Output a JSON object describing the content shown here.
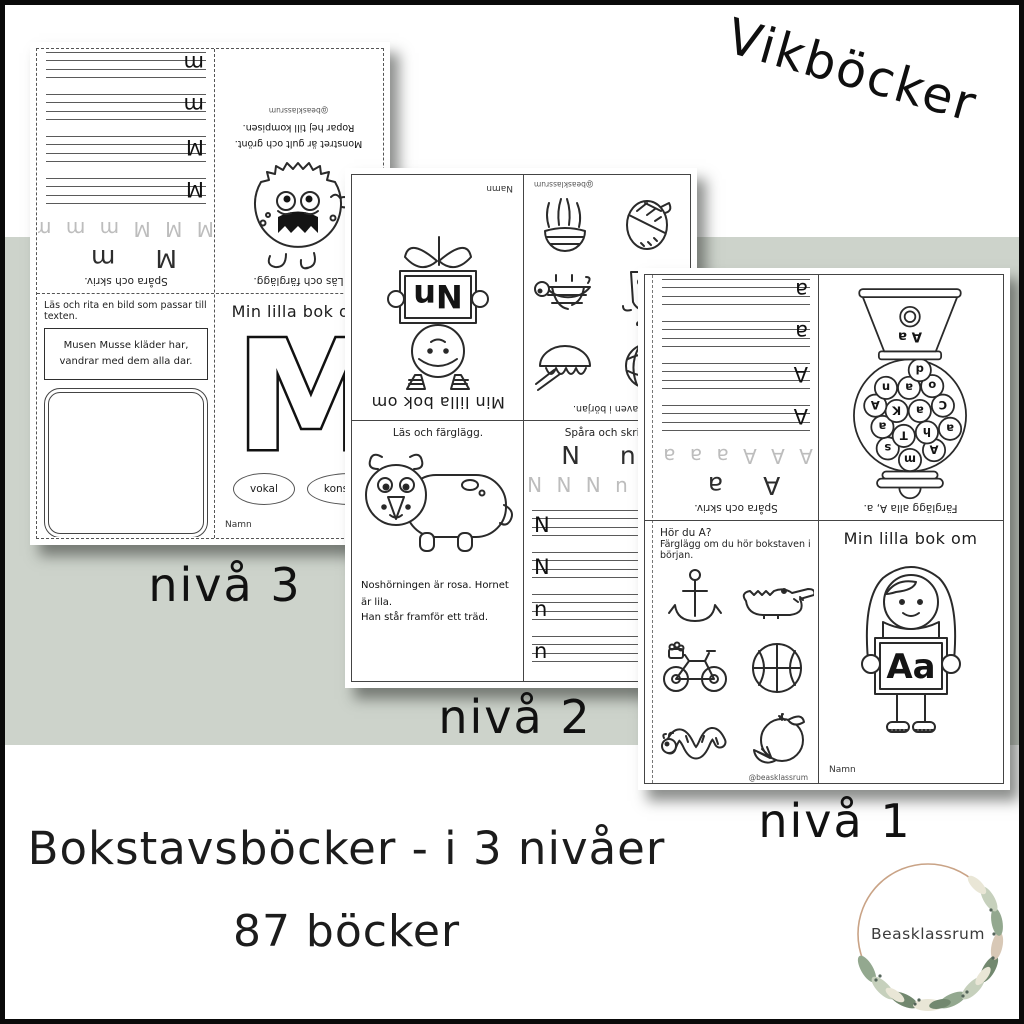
{
  "colors": {
    "band": "#cdd3cb",
    "paper": "#ffffff",
    "frame": "#0a0a0a",
    "ink": "#1c1c1c",
    "wreath_ring": "#c9a386"
  },
  "header": {
    "handwritten_title": "Vikböcker"
  },
  "level_labels": {
    "level3": "nivå 3",
    "level2": "nivå 2",
    "level1": "nivå 1"
  },
  "footer": {
    "line1": "Bokstavsböcker - i 3 nivåer",
    "line2": "87 böcker"
  },
  "logo": {
    "text": "Beasklassrum"
  },
  "sheet_m": {
    "trace": {
      "caption": "Spåra och skriv.",
      "pair": "M m",
      "gray_row": "M M M m m m",
      "letters": [
        "M",
        "M",
        "m",
        "m"
      ]
    },
    "monster": {
      "caption": "Läs och färglägg.",
      "text1": "Monstret är gult och grönt.",
      "text2": "Ropar hej till kompisen.",
      "credit": "@beasklassrum"
    },
    "draw": {
      "caption": "Läs och rita en bild som passar till texten.",
      "story1": "Musen Musse kläder har,",
      "story2": "vandrar med dem alla dar."
    },
    "cover": {
      "title": "Min lilla bok om",
      "letter": "M",
      "oval1": "vokal",
      "oval2": "konsonant",
      "name_label": "Namn"
    }
  },
  "sheet_n": {
    "cover": {
      "title": "Min lilla bok om",
      "sign": "Nn",
      "name_label": "Namn"
    },
    "pictures": {
      "caption": "hör bokstaven i början.",
      "credit": "@beasklassrum"
    },
    "read_color": {
      "caption": "Läs och färglägg.",
      "text1": "Noshörningen är rosa. Hornet är lila.",
      "text2": "Han står framför ett träd."
    },
    "trace": {
      "caption": "Spåra och skriv.",
      "pair": "N n",
      "gray_row": "N N N n n n",
      "letters": [
        "N",
        "N",
        "n",
        "n"
      ]
    }
  },
  "sheet_a": {
    "trace": {
      "caption": "Spåra och skriv.",
      "pair": "A a",
      "gray_row": "A A A a a a",
      "letters": [
        "A",
        "A",
        "a",
        "a"
      ]
    },
    "gumball": {
      "caption": "Färglägg alla A, a.",
      "machine_label": "A a",
      "letters": [
        "A",
        "m",
        "s",
        "a",
        "h",
        "T",
        "a",
        "C",
        "a",
        "K",
        "A",
        "o",
        "a",
        "n",
        "d"
      ]
    },
    "sound": {
      "question": "Hör du A?",
      "instruction": "Färglägg om du hör bokstaven i början.",
      "credit": "@beasklassrum"
    },
    "cover": {
      "title": "Min lilla bok om",
      "sign": "Aa",
      "name_label": "Namn"
    }
  }
}
